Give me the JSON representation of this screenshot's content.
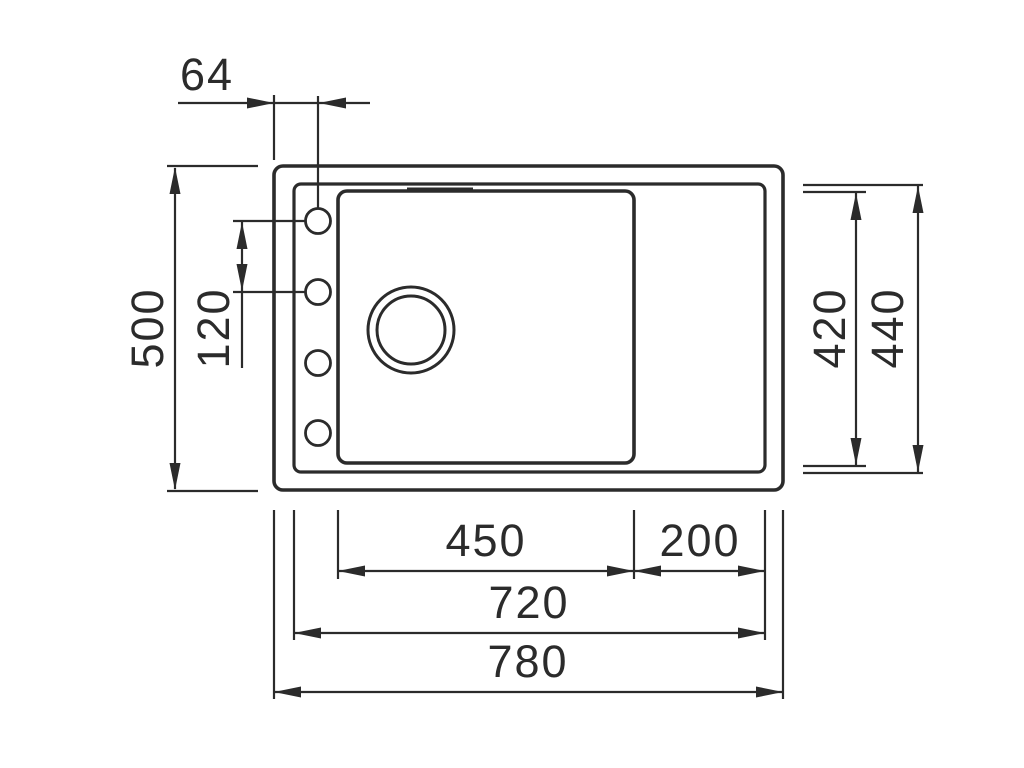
{
  "diagram": {
    "type": "technical-drawing-top-view",
    "dims": {
      "hole_offset": "64",
      "overall_depth": "500",
      "hole_pitch": "120",
      "bowl_depth": "420",
      "rim_depth": "440",
      "bowl_width": "450",
      "drainer_width": "200",
      "rim_width": "720",
      "overall_width": "780"
    },
    "features": {
      "faucet_hole_count": 4,
      "drain_count": 1
    },
    "colors": {
      "line": "#2b2b2b",
      "background": "#ffffff"
    }
  }
}
